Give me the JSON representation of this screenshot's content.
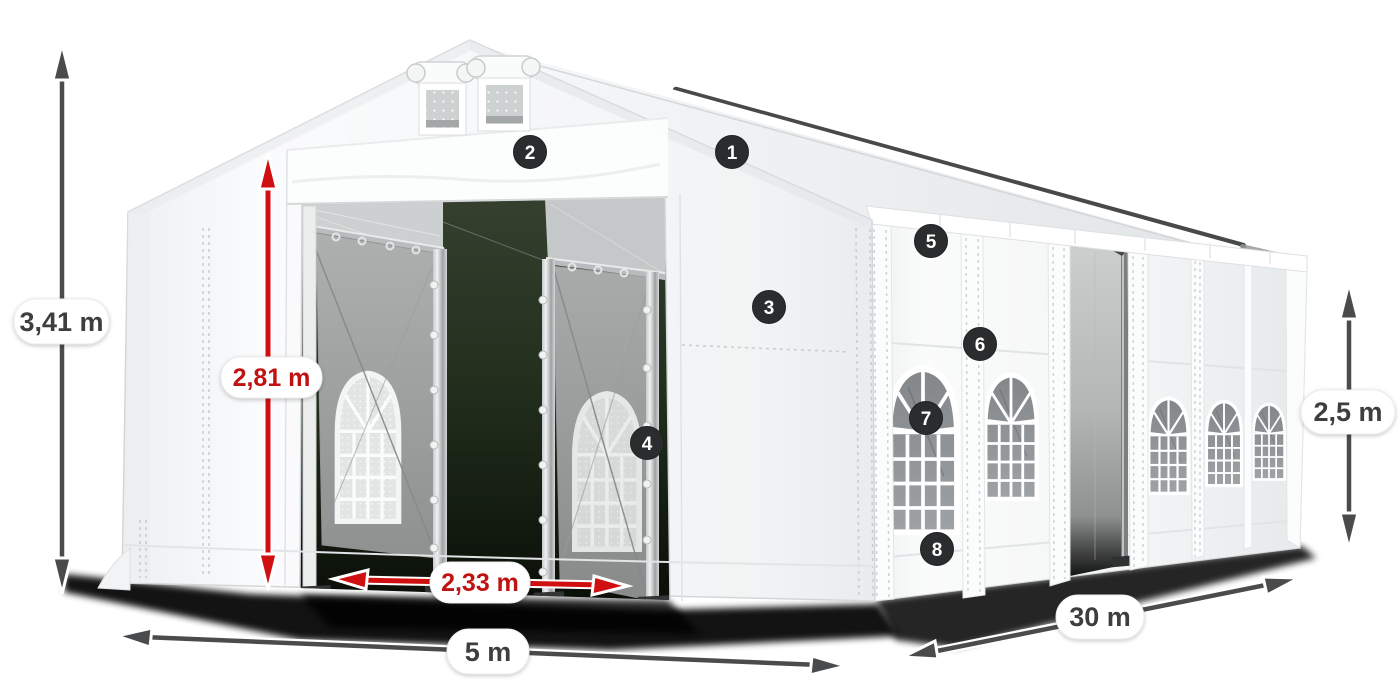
{
  "diagram": {
    "subject": "party-tent-dimension-diagram",
    "dimensions": {
      "total_height": {
        "label": "3,41 m",
        "color": "#3e3e40"
      },
      "entrance_height": {
        "label": "2,81 m",
        "color": "#c11212"
      },
      "entrance_width": {
        "label": "2,33 m",
        "color": "#c11212"
      },
      "front_width": {
        "label": "5 m",
        "color": "#3e3e40"
      },
      "side_length": {
        "label": "30 m",
        "color": "#3e3e40"
      },
      "side_height": {
        "label": "2,5 m",
        "color": "#3e3e40"
      }
    },
    "badges": [
      {
        "number": "1"
      },
      {
        "number": "2"
      },
      {
        "number": "3"
      },
      {
        "number": "4"
      },
      {
        "number": "5"
      },
      {
        "number": "6"
      },
      {
        "number": "7"
      },
      {
        "number": "8"
      }
    ],
    "colors": {
      "accent_red": "#d01010",
      "arrow_gray": "#4a4b4d",
      "badge_bg": "#2b2c2e",
      "tent_white": "#f7f8f9",
      "shadow": "#000000"
    }
  }
}
